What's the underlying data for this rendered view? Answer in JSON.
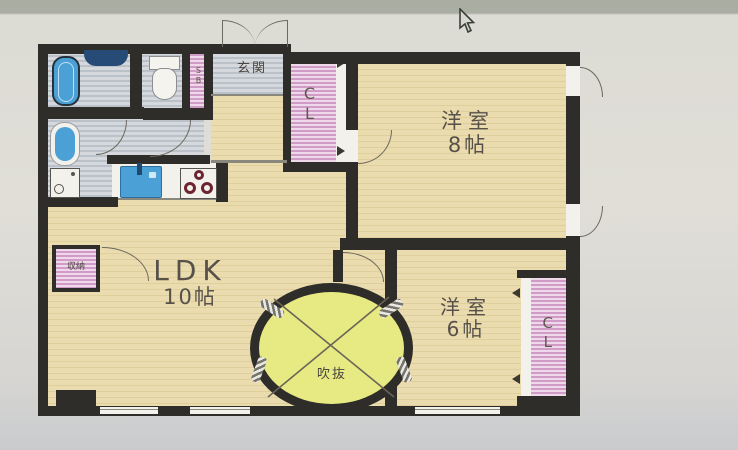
{
  "plan": {
    "rooms": {
      "ldk": {
        "line1": "LDK",
        "line2": "10帖"
      },
      "bedroom8": {
        "line1": "洋室",
        "line2": "8帖"
      },
      "bedroom6": {
        "line1": "洋室",
        "line2": "6帖"
      },
      "entrance": {
        "label": "玄関"
      },
      "atrium": {
        "label": "吹抜"
      }
    },
    "closets": {
      "cl_top": "CL",
      "cl_bottom": "CL",
      "shoe_box": "SB",
      "storage": "収納"
    },
    "fixtures": [
      "bathtub",
      "vanity-counter",
      "toilet",
      "washbasin",
      "laundry-pan",
      "kitchen-sink",
      "stove-burners"
    ],
    "colors": {
      "wall": "#2f2d29",
      "wood_floor": "#e8daab",
      "tile_floor": "#c9ced5",
      "closet_pink": "#e2b7d8",
      "atrium_green": "#e7ea83",
      "fixture_blue": "#4ba0d5",
      "burner_red": "#6e2330"
    }
  }
}
